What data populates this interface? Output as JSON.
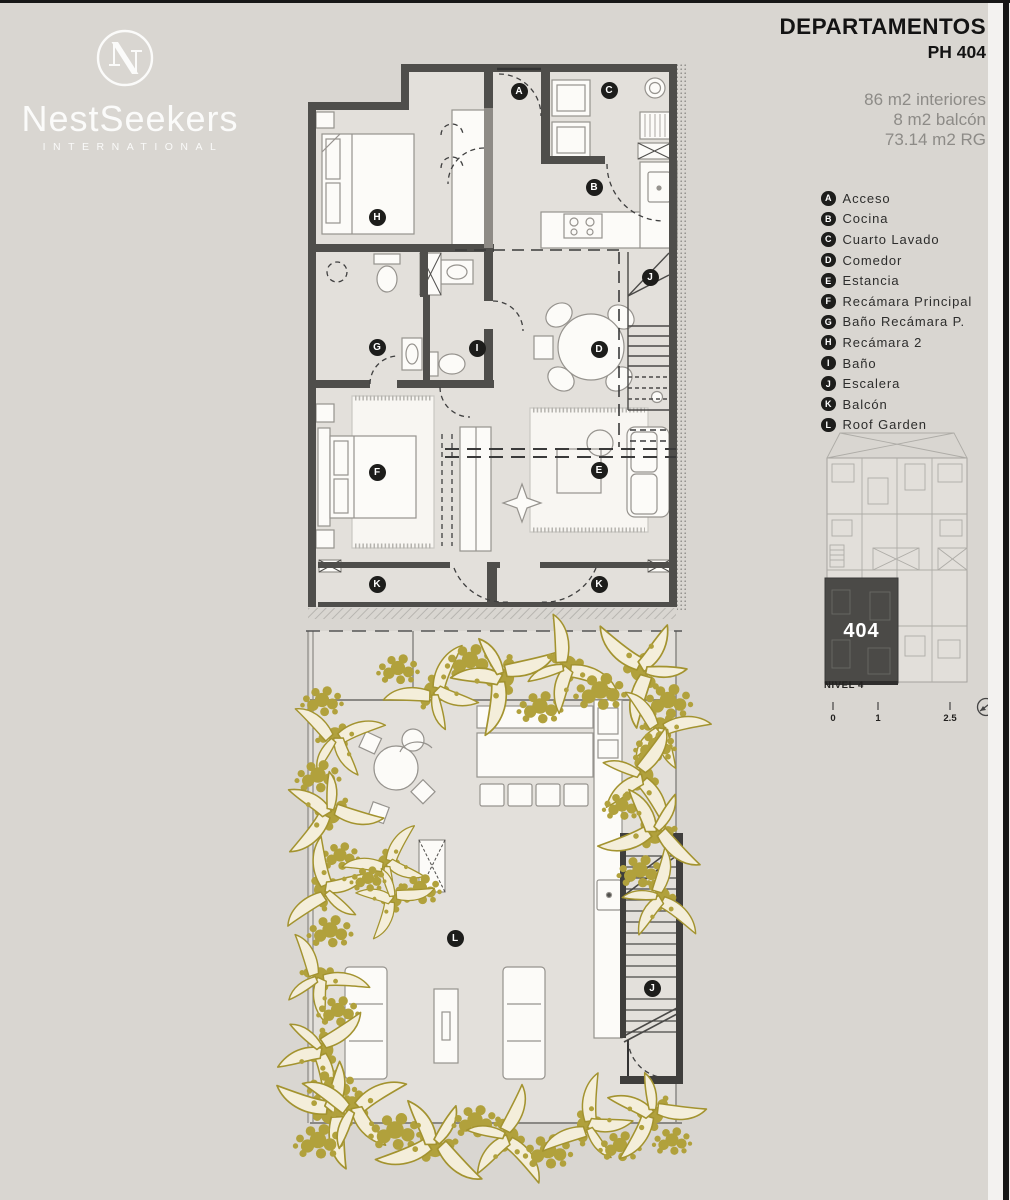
{
  "brand": {
    "name": "NestSeekers",
    "subtitle": "INTERNATIONAL"
  },
  "header": {
    "title": "DEPARTAMENTOS",
    "unit": "PH 404"
  },
  "areas": [
    "86 m2 interiores",
    "8 m2 balcón",
    "73.14 m2 RG"
  ],
  "legend": {
    "items": [
      {
        "letter": "A",
        "label": "Acceso"
      },
      {
        "letter": "B",
        "label": "Cocina"
      },
      {
        "letter": "C",
        "label": "Cuarto Lavado"
      },
      {
        "letter": "D",
        "label": "Comedor"
      },
      {
        "letter": "E",
        "label": "Estancia"
      },
      {
        "letter": "F",
        "label": "Recámara Principal"
      },
      {
        "letter": "G",
        "label": "Baño Recámara P."
      },
      {
        "letter": "H",
        "label": "Recámara 2"
      },
      {
        "letter": "I",
        "label": "Baño"
      },
      {
        "letter": "J",
        "label": "Escalera"
      },
      {
        "letter": "K",
        "label": "Balcón"
      },
      {
        "letter": "L",
        "label": "Roof Garden"
      }
    ]
  },
  "minimap": {
    "unit_number": "404",
    "level_label": "NIVEL 4",
    "scale_ticks": [
      "0",
      "1",
      "2.5"
    ]
  },
  "plan_badges": {
    "upper": [
      {
        "letter": "A",
        "x": 519,
        "y": 91
      },
      {
        "letter": "C",
        "x": 609,
        "y": 90
      },
      {
        "letter": "B",
        "x": 594,
        "y": 187
      },
      {
        "letter": "H",
        "x": 377,
        "y": 217
      },
      {
        "letter": "J",
        "x": 650,
        "y": 277
      },
      {
        "letter": "G",
        "x": 377,
        "y": 347
      },
      {
        "letter": "I",
        "x": 477,
        "y": 348
      },
      {
        "letter": "D",
        "x": 599,
        "y": 349
      },
      {
        "letter": "F",
        "x": 377,
        "y": 472
      },
      {
        "letter": "E",
        "x": 599,
        "y": 470
      },
      {
        "letter": "K",
        "x": 377,
        "y": 584
      },
      {
        "letter": "K",
        "x": 599,
        "y": 584
      }
    ],
    "lower": [
      {
        "letter": "L",
        "x": 455,
        "y": 938
      },
      {
        "letter": "J",
        "x": 652,
        "y": 988
      }
    ]
  },
  "colors": {
    "background": "#d9d6d1",
    "wall_dark": "#4f4e4b",
    "plant_gold": "#b1a13c",
    "leaf_cream": "#f4eeda",
    "unit_highlight": "#4b4a47"
  }
}
